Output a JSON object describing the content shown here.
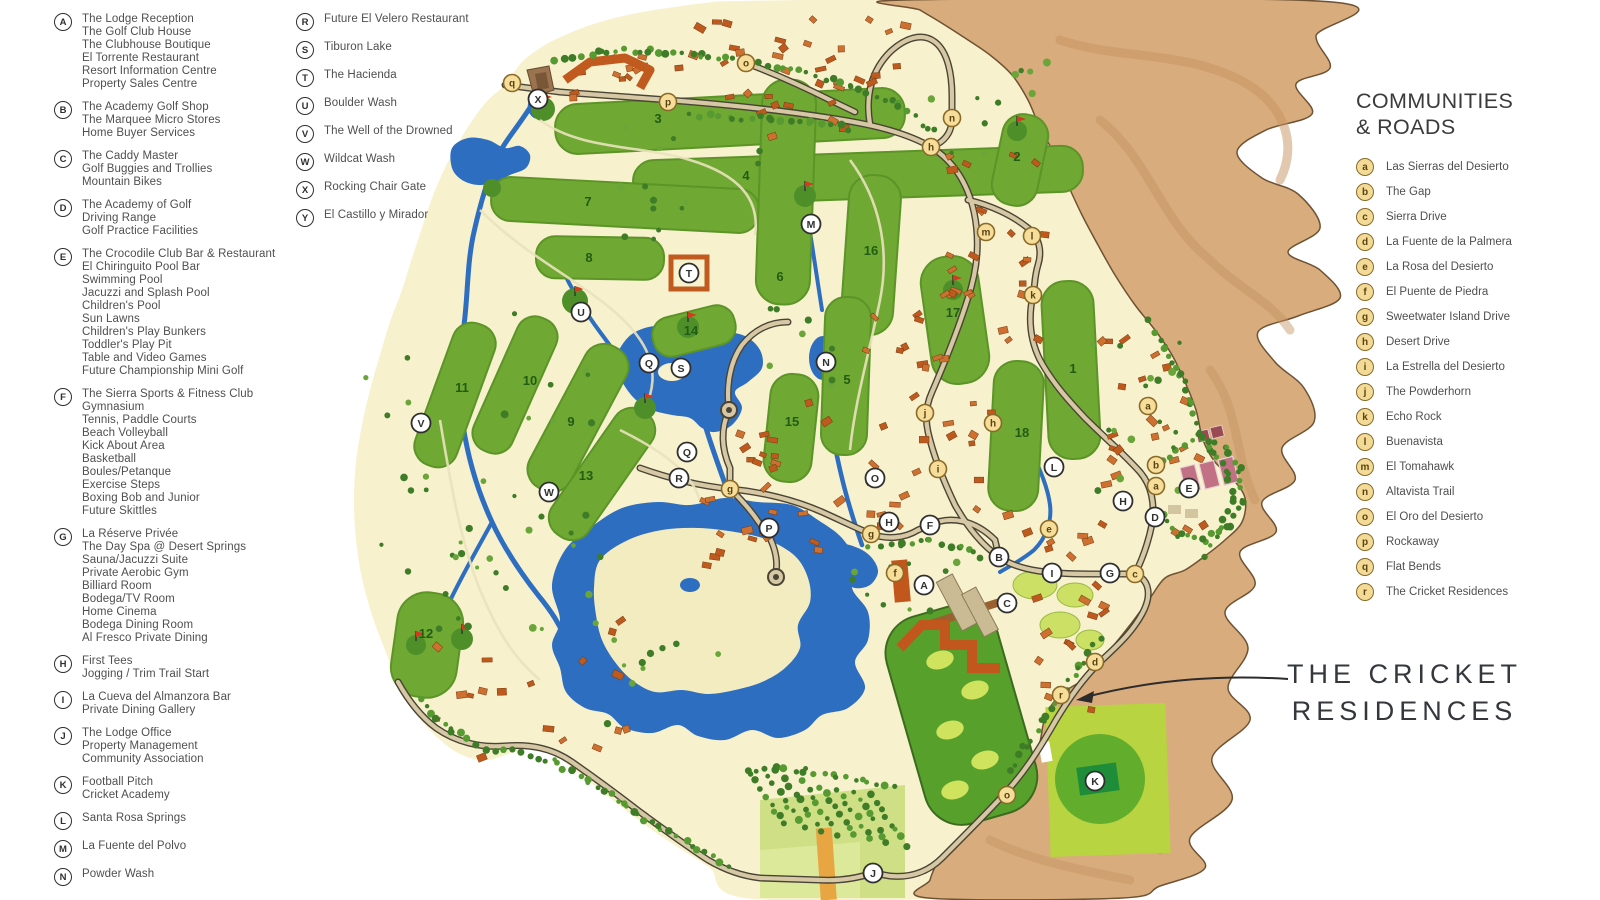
{
  "legend_left": {
    "items": [
      {
        "letter": "A",
        "lines": [
          "The Lodge Reception",
          "The Golf Club House",
          "The Clubhouse Boutique",
          "El Torrente Restaurant",
          "Resort Information Centre",
          "Property Sales Centre"
        ]
      },
      {
        "letter": "B",
        "lines": [
          "The Academy Golf Shop",
          "The Marquee Micro Stores",
          "Home Buyer Services"
        ]
      },
      {
        "letter": "C",
        "lines": [
          "The Caddy Master",
          "Golf Buggies and Trollies",
          "Mountain Bikes"
        ]
      },
      {
        "letter": "D",
        "lines": [
          "The Academy of Golf",
          "Driving Range",
          "Golf Practice Facilities"
        ]
      },
      {
        "letter": "E",
        "lines": [
          "The Crocodile Club Bar & Restaurant",
          "El Chiringuito Pool Bar",
          "Swimming Pool",
          "Jacuzzi and Splash Pool",
          "Children's Pool",
          "Sun Lawns",
          "Children's Play Bunkers",
          "Toddler's Play Pit",
          "Table and Video Games",
          "Future Championship Mini Golf"
        ]
      },
      {
        "letter": "F",
        "lines": [
          "The Sierra Sports & Fitness Club",
          "Gymnasium",
          "Tennis, Paddle Courts",
          "Beach Volleyball",
          "Kick About Area",
          "Basketball",
          "Boules/Petanque",
          "Exercise Steps",
          "Boxing Bob and Junior",
          "Future Skittles"
        ]
      },
      {
        "letter": "G",
        "lines": [
          "La Réserve Privée",
          "The Day Spa @ Desert Springs",
          "Sauna/Jacuzzi Suite",
          "Private Aerobic Gym",
          "Billiard Room",
          "Bodega/TV Room",
          "Home Cinema",
          "Bodega Dining Room",
          "Al Fresco Private Dining"
        ]
      },
      {
        "letter": "H",
        "lines": [
          "First Tees",
          "Jogging / Trim Trail Start"
        ]
      },
      {
        "letter": "I",
        "lines": [
          "La Cueva del Almanzora Bar",
          "Private Dining Gallery"
        ]
      },
      {
        "letter": "J",
        "lines": [
          "The Lodge Office",
          "Property Management",
          "Community Association"
        ]
      },
      {
        "letter": "K",
        "lines": [
          "Football Pitch",
          "Cricket Academy"
        ]
      },
      {
        "letter": "L",
        "lines": [
          "Santa Rosa Springs"
        ]
      },
      {
        "letter": "M",
        "lines": [
          "La Fuente del Polvo"
        ]
      },
      {
        "letter": "N",
        "lines": [
          "Powder Wash"
        ]
      }
    ]
  },
  "legend_mid": {
    "items": [
      {
        "letter": "R",
        "lines": [
          "Future El Velero Restaurant"
        ]
      },
      {
        "letter": "S",
        "lines": [
          "Tiburon Lake"
        ]
      },
      {
        "letter": "T",
        "lines": [
          "The Hacienda"
        ]
      },
      {
        "letter": "U",
        "lines": [
          "Boulder Wash"
        ]
      },
      {
        "letter": "V",
        "lines": [
          "The Well of the Drowned"
        ]
      },
      {
        "letter": "W",
        "lines": [
          "Wildcat Wash"
        ]
      },
      {
        "letter": "X",
        "lines": [
          "Rocking Chair Gate"
        ]
      },
      {
        "letter": "Y",
        "lines": [
          "El Castillo y Mirador"
        ]
      }
    ]
  },
  "communities": {
    "title_line1": "COMMUNITIES",
    "title_line2": "& ROADS",
    "items": [
      {
        "letter": "a",
        "label": "Las Sierras del Desierto"
      },
      {
        "letter": "b",
        "label": "The Gap"
      },
      {
        "letter": "c",
        "label": "Sierra Drive"
      },
      {
        "letter": "d",
        "label": "La Fuente de la Palmera"
      },
      {
        "letter": "e",
        "label": "La Rosa del Desierto"
      },
      {
        "letter": "f",
        "label": "El Puente de Piedra"
      },
      {
        "letter": "g",
        "label": "Sweetwater Island Drive"
      },
      {
        "letter": "h",
        "label": "Desert Drive"
      },
      {
        "letter": "i",
        "label": "La Estrella del Desierto"
      },
      {
        "letter": "j",
        "label": "The Powderhorn"
      },
      {
        "letter": "k",
        "label": "Echo Rock"
      },
      {
        "letter": "l",
        "label": "Buenavista"
      },
      {
        "letter": "m",
        "label": "El Tomahawk"
      },
      {
        "letter": "n",
        "label": "Altavista Trail"
      },
      {
        "letter": "o",
        "label": "El Oro del Desierto"
      },
      {
        "letter": "p",
        "label": "Rockaway"
      },
      {
        "letter": "q",
        "label": "Flat Bends"
      },
      {
        "letter": "r",
        "label": "The Cricket Residences"
      }
    ]
  },
  "callout": {
    "line1": "THE CRICKET",
    "line2": "RESIDENCES"
  },
  "map": {
    "colors": {
      "cream": "#f7f1cd",
      "desert": "#d8ac7c",
      "desert_dark": "#c6925f",
      "water": "#2e6ec0",
      "fairway": "#6fa832",
      "green_dark": "#4e8f2a",
      "tree": "#3e7c27",
      "road_fill": "#d6c8a4",
      "road_edge": "#4a4435",
      "building": "#c05a1e",
      "court_pink": "#c17183",
      "pitch": "#1f8c3a"
    },
    "holes": [
      {
        "n": "1",
        "x": 1073,
        "y": 369
      },
      {
        "n": "2",
        "x": 1017,
        "y": 157
      },
      {
        "n": "3",
        "x": 658,
        "y": 119
      },
      {
        "n": "4",
        "x": 746,
        "y": 176
      },
      {
        "n": "5",
        "x": 847,
        "y": 380
      },
      {
        "n": "6",
        "x": 780,
        "y": 277
      },
      {
        "n": "7",
        "x": 588,
        "y": 202
      },
      {
        "n": "8",
        "x": 589,
        "y": 258
      },
      {
        "n": "9",
        "x": 571,
        "y": 422
      },
      {
        "n": "10",
        "x": 530,
        "y": 381
      },
      {
        "n": "11",
        "x": 462,
        "y": 388
      },
      {
        "n": "12",
        "x": 426,
        "y": 634
      },
      {
        "n": "13",
        "x": 586,
        "y": 476
      },
      {
        "n": "14",
        "x": 691,
        "y": 331
      },
      {
        "n": "15",
        "x": 792,
        "y": 422
      },
      {
        "n": "16",
        "x": 871,
        "y": 251
      },
      {
        "n": "17",
        "x": 953,
        "y": 313
      },
      {
        "n": "18",
        "x": 1022,
        "y": 433
      }
    ],
    "markers_upper": [
      {
        "l": "A",
        "x": 924,
        "y": 585
      },
      {
        "l": "B",
        "x": 999,
        "y": 557
      },
      {
        "l": "C",
        "x": 1007,
        "y": 603
      },
      {
        "l": "D",
        "x": 1155,
        "y": 517
      },
      {
        "l": "E",
        "x": 1189,
        "y": 488
      },
      {
        "l": "F",
        "x": 930,
        "y": 525
      },
      {
        "l": "G",
        "x": 1110,
        "y": 573
      },
      {
        "l": "H",
        "x": 889,
        "y": 522
      },
      {
        "l": "H",
        "x": 1123,
        "y": 501
      },
      {
        "l": "I",
        "x": 1052,
        "y": 573
      },
      {
        "l": "J",
        "x": 873,
        "y": 873
      },
      {
        "l": "K",
        "x": 1095,
        "y": 781
      },
      {
        "l": "L",
        "x": 1054,
        "y": 467
      },
      {
        "l": "M",
        "x": 811,
        "y": 224
      },
      {
        "l": "N",
        "x": 826,
        "y": 362
      },
      {
        "l": "O",
        "x": 875,
        "y": 478
      },
      {
        "l": "P",
        "x": 769,
        "y": 528
      },
      {
        "l": "Q",
        "x": 649,
        "y": 363
      },
      {
        "l": "Q",
        "x": 687,
        "y": 452
      },
      {
        "l": "R",
        "x": 679,
        "y": 478
      },
      {
        "l": "S",
        "x": 681,
        "y": 368
      },
      {
        "l": "T",
        "x": 689,
        "y": 273
      },
      {
        "l": "U",
        "x": 581,
        "y": 312
      },
      {
        "l": "V",
        "x": 421,
        "y": 423
      },
      {
        "l": "W",
        "x": 549,
        "y": 492
      },
      {
        "l": "X",
        "x": 538,
        "y": 99
      }
    ],
    "markers_lower": [
      {
        "l": "q",
        "x": 512,
        "y": 83
      },
      {
        "l": "p",
        "x": 668,
        "y": 102
      },
      {
        "l": "o",
        "x": 746,
        "y": 63
      },
      {
        "l": "n",
        "x": 952,
        "y": 118
      },
      {
        "l": "h",
        "x": 931,
        "y": 147
      },
      {
        "l": "m",
        "x": 986,
        "y": 232
      },
      {
        "l": "l",
        "x": 1032,
        "y": 236
      },
      {
        "l": "k",
        "x": 1033,
        "y": 295
      },
      {
        "l": "j",
        "x": 925,
        "y": 413
      },
      {
        "l": "h",
        "x": 993,
        "y": 423
      },
      {
        "l": "i",
        "x": 938,
        "y": 469
      },
      {
        "l": "a",
        "x": 1148,
        "y": 406
      },
      {
        "l": "b",
        "x": 1156,
        "y": 465
      },
      {
        "l": "a",
        "x": 1156,
        "y": 486
      },
      {
        "l": "g",
        "x": 730,
        "y": 489
      },
      {
        "l": "g",
        "x": 871,
        "y": 534
      },
      {
        "l": "e",
        "x": 1049,
        "y": 529
      },
      {
        "l": "f",
        "x": 895,
        "y": 573
      },
      {
        "l": "c",
        "x": 1135,
        "y": 574
      },
      {
        "l": "d",
        "x": 1095,
        "y": 662
      },
      {
        "l": "r",
        "x": 1061,
        "y": 695
      },
      {
        "l": "o",
        "x": 1007,
        "y": 795
      }
    ]
  }
}
